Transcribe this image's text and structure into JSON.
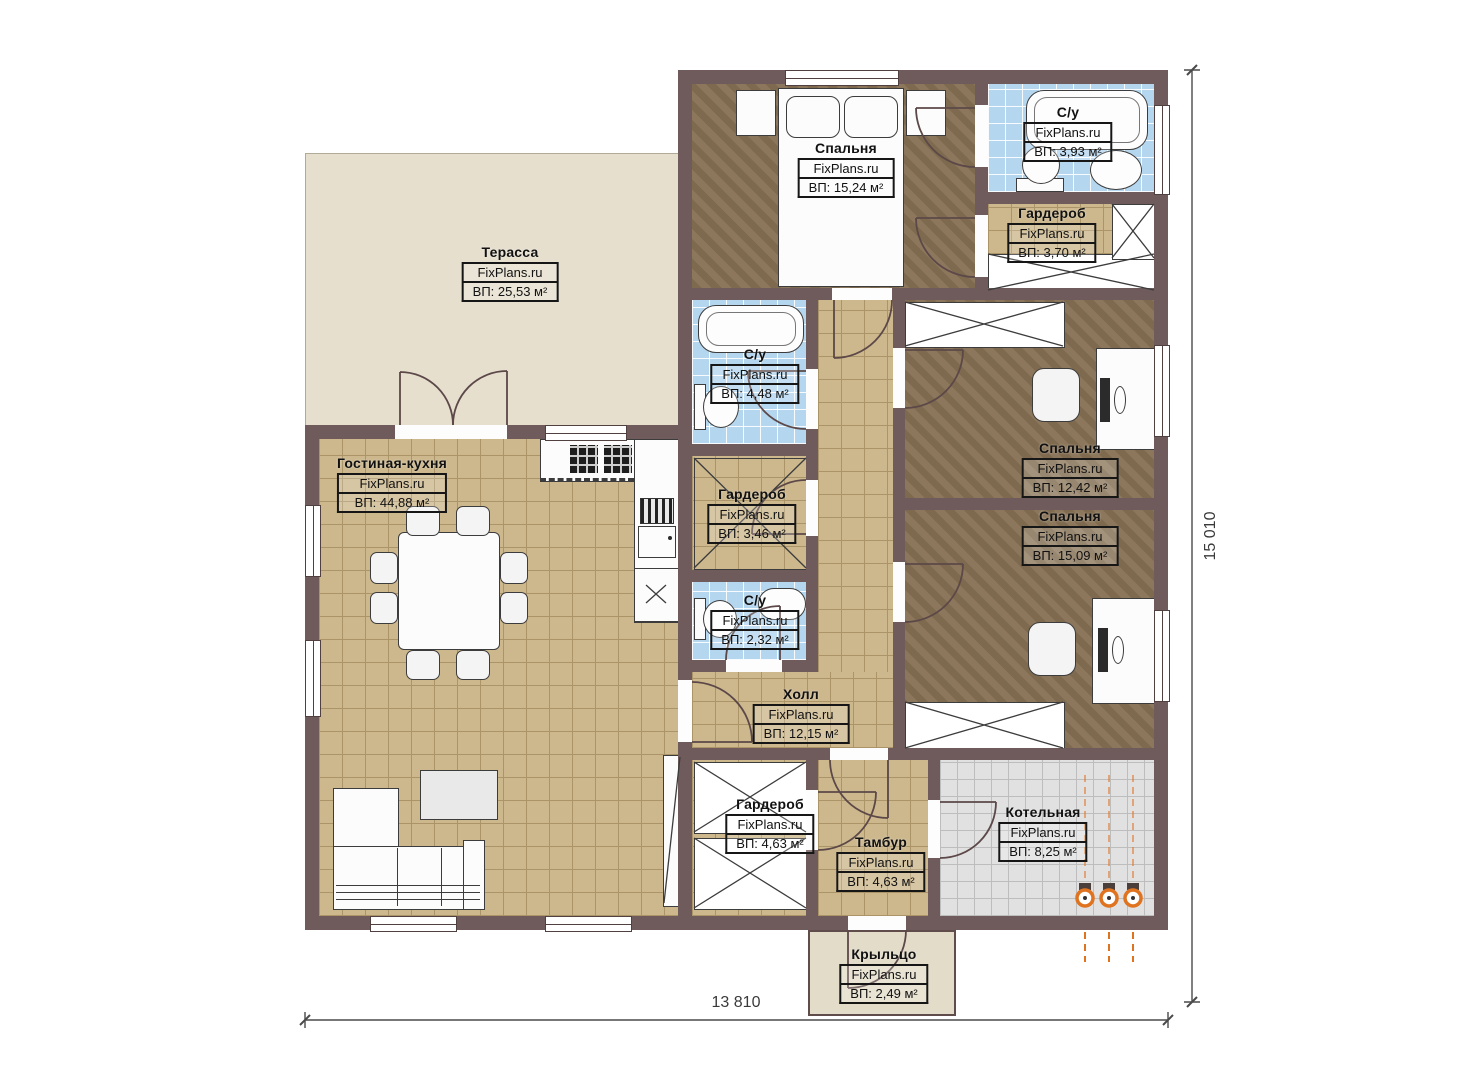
{
  "watermark": "FixPlans.ru",
  "rooms": [
    {
      "id": "terrace",
      "name": "Терасса",
      "area": "ВП: 25,53 м²"
    },
    {
      "id": "bedroom-top",
      "name": "Спальня",
      "area": "ВП: 15,24 м²"
    },
    {
      "id": "bathroom-top",
      "name": "С/у",
      "area": "ВП: 3,93 м²"
    },
    {
      "id": "wardrobe-top",
      "name": "Гардероб",
      "area": "ВП: 3,70 м²"
    },
    {
      "id": "bathroom-mid",
      "name": "С/у",
      "area": "ВП: 4,48 м²"
    },
    {
      "id": "living-kitchen",
      "name": "Гостиная-кухня",
      "area": "ВП: 44,88 м²"
    },
    {
      "id": "wardrobe-mid",
      "name": "Гардероб",
      "area": "ВП: 3,46 м²"
    },
    {
      "id": "bathroom-small",
      "name": "С/у",
      "area": "ВП: 2,32 м²"
    },
    {
      "id": "bedroom-right-1",
      "name": "Спальня",
      "area": "ВП: 12,42 м²"
    },
    {
      "id": "bedroom-right-2",
      "name": "Спальня",
      "area": "ВП: 15,09 м²"
    },
    {
      "id": "hall",
      "name": "Холл",
      "area": "ВП: 12,15 м²"
    },
    {
      "id": "wardrobe-bottom",
      "name": "Гардероб",
      "area": "ВП: 4,63 м²"
    },
    {
      "id": "vestibule",
      "name": "Тамбур",
      "area": "ВП: 4,63 м²"
    },
    {
      "id": "boiler-room",
      "name": "Котельная",
      "area": "ВП: 8,25 м²"
    },
    {
      "id": "porch",
      "name": "Крыльцо",
      "area": "ВП: 2,49 м²"
    }
  ],
  "dimensions": {
    "width_mm": "13 810",
    "height_mm": "15 010"
  },
  "colors": {
    "wall": "#6f5b5b",
    "floor_wood": "#867053",
    "floor_tile_tan": "#cdb88e",
    "floor_tile_blue": "#b5d6ef",
    "floor_tile_gray": "#e1e1e1",
    "terrace": "#e6dfce",
    "pipes_accent": "#e0731f"
  }
}
